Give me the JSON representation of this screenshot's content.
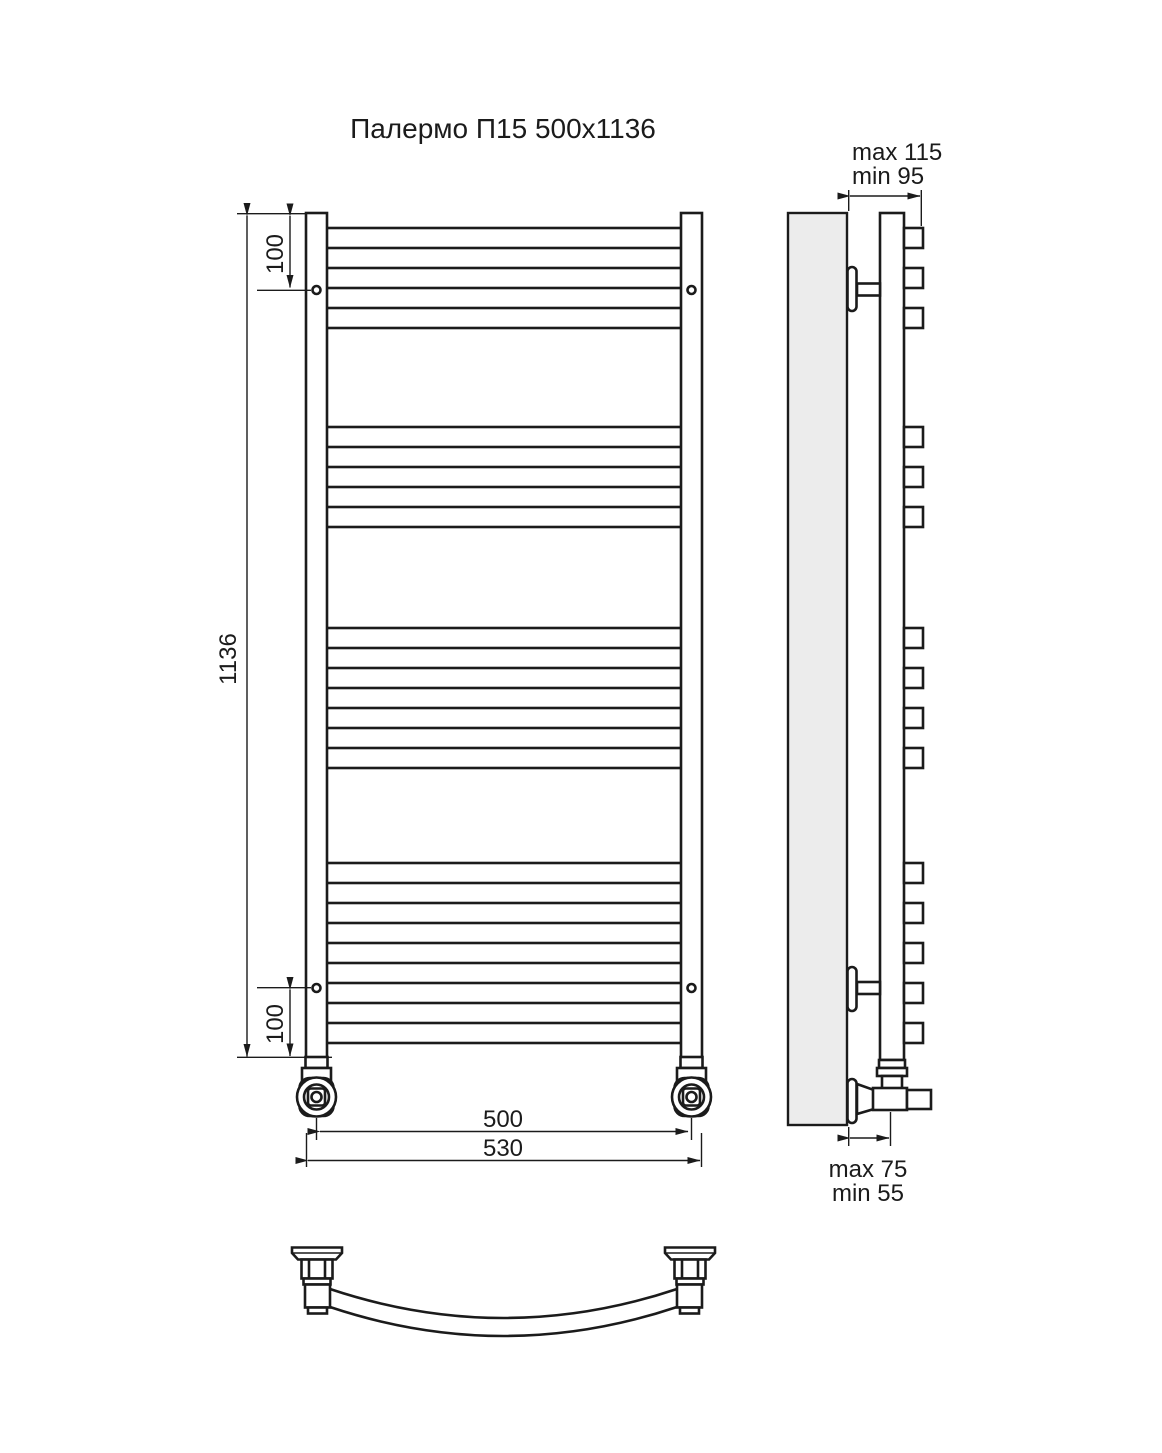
{
  "title": "Палермо П15 500х1136",
  "front_view": {
    "dim_height": "1136",
    "dim_top_hole_offset": "100",
    "dim_bottom_hole_offset": "100",
    "dim_connection_width": "500",
    "dim_overall_width": "530"
  },
  "side_view": {
    "wall_clearance_top": {
      "max": "max 115",
      "min": "min 95"
    },
    "wall_clearance_bottom": {
      "max": "max 75",
      "min": "min 55"
    }
  },
  "rungs": {
    "count": 15,
    "grouping": [
      3,
      3,
      4,
      5
    ],
    "tube_thickness_px": 20,
    "y_positions": [
      228,
      268,
      308,
      427,
      467,
      507,
      628,
      668,
      708,
      748,
      863,
      903,
      943,
      983,
      1023
    ]
  },
  "colors": {
    "line": "#1b1b1b",
    "wall_fill": "#ececec",
    "background": "#ffffff"
  }
}
